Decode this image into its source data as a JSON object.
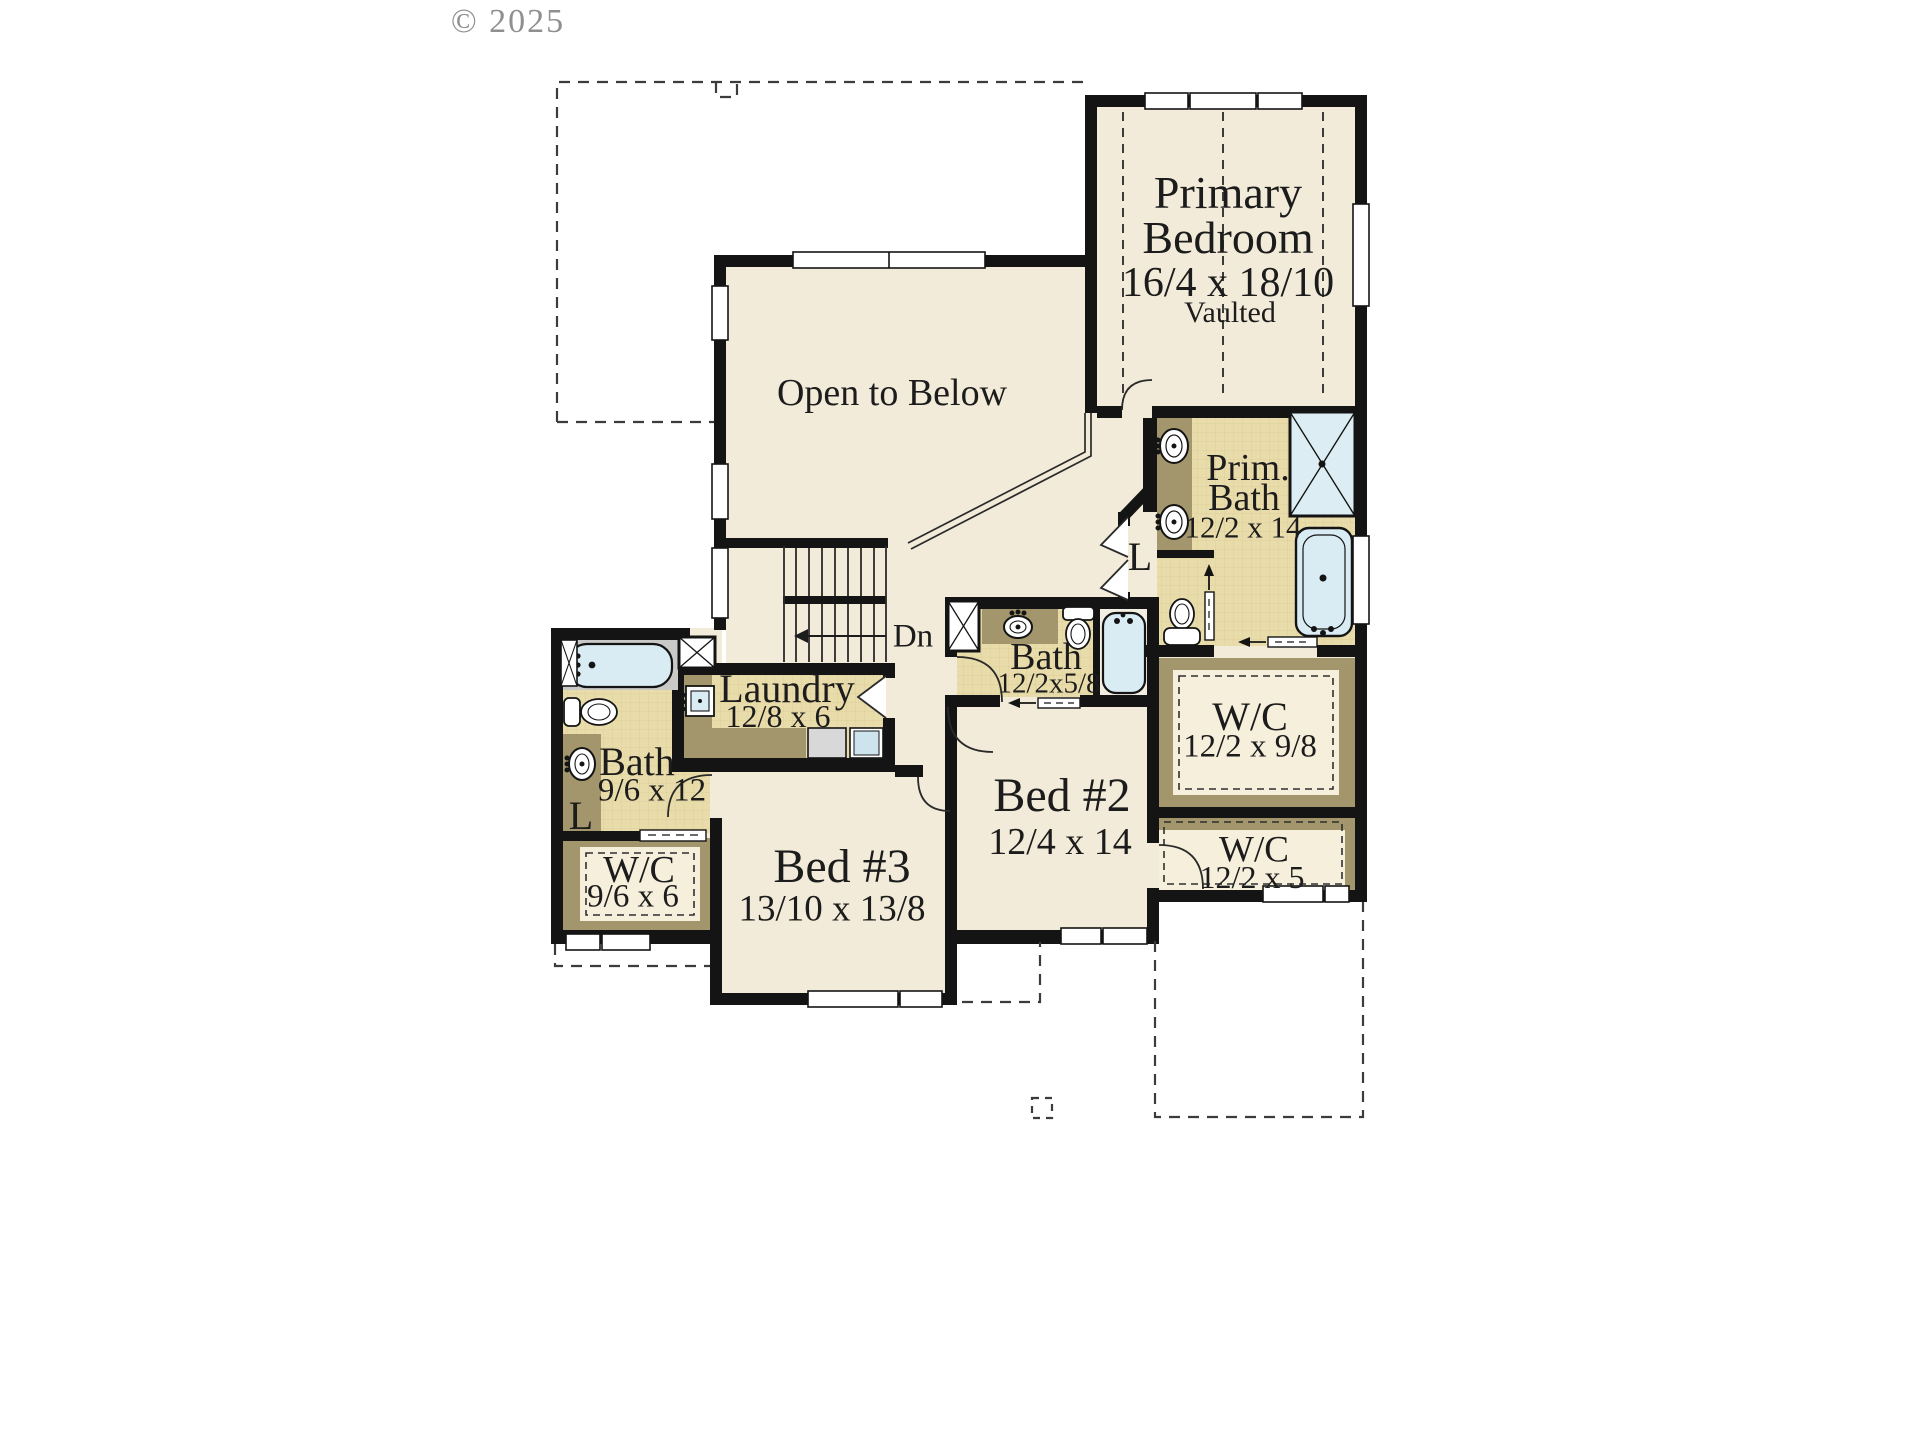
{
  "watermark": "© 2025",
  "plan": {
    "primary_bedroom": {
      "line1": "Primary",
      "line2": "Bedroom",
      "dims": "16/4 x 18/10",
      "note": "Vaulted"
    },
    "open_to_below": {
      "label": "Open to Below"
    },
    "primary_bath": {
      "line1": "Prim.",
      "line2": "Bath",
      "dims": "12/2 x 14"
    },
    "walkin_closet_primary": {
      "label": "W/C",
      "dims": "12/2 x 9/8"
    },
    "closet_small": {
      "label": "W/C",
      "dims": "12/2 x 5"
    },
    "hall_bath": {
      "label": "Bath",
      "dims": "12/2x5/8"
    },
    "bed2": {
      "label": "Bed #2",
      "dims": "12/4 x 14"
    },
    "bed3": {
      "label": "Bed #3",
      "dims": "13/10 x 13/8"
    },
    "laundry": {
      "label": "Laundry",
      "dims": "12/8 x 6"
    },
    "bath_left": {
      "label": "Bath",
      "dims": "9/6 x 12"
    },
    "closet_left": {
      "label": "W/C",
      "dims": "9/6 x 6"
    },
    "stairs": {
      "label": "Dn"
    },
    "linen_bath": {
      "label": "L"
    },
    "linen_hall": {
      "label": "L"
    }
  },
  "colors": {
    "floor": "#f2ebd9",
    "tile": "#e9dcab",
    "counter": "#a3966c",
    "shelf_interior": "#f5efdc",
    "wall": "#141414",
    "fixture_blue": "#d9ecf4",
    "tub_surround": "#c9c9c7",
    "dashed_line": "#3c3c3c",
    "text": "#1c1c1c",
    "watermark": "#8f8f8f"
  }
}
